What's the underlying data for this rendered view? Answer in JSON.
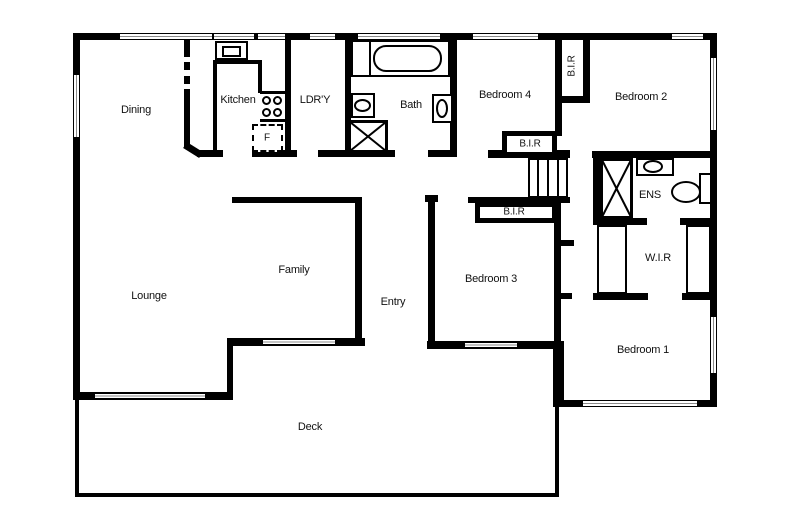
{
  "plan": {
    "type": "house-floor-plan",
    "colors": {
      "wall": "#000000",
      "background": "#ffffff"
    },
    "rooms": {
      "dining": {
        "label": "Dining"
      },
      "kitchen": {
        "label": "Kitchen"
      },
      "laundry": {
        "label": "LDR'Y"
      },
      "bath": {
        "label": "Bath"
      },
      "bedroom4": {
        "label": "Bedroom 4"
      },
      "bedroom2": {
        "label": "Bedroom 2"
      },
      "bedroom3": {
        "label": "Bedroom 3"
      },
      "bedroom1": {
        "label": "Bedroom 1"
      },
      "ens": {
        "label": "ENS"
      },
      "wir": {
        "label": "W.I.R"
      },
      "family": {
        "label": "Family"
      },
      "entry": {
        "label": "Entry"
      },
      "lounge": {
        "label": "Lounge"
      },
      "deck": {
        "label": "Deck"
      },
      "bir_bedroom2": {
        "label": "B.I.R"
      },
      "bir_middle": {
        "label": "B.I.R"
      },
      "bir_bedroom3": {
        "label": "B.I.R"
      }
    },
    "fixtures": {
      "fridge": {
        "label": "F"
      }
    }
  }
}
